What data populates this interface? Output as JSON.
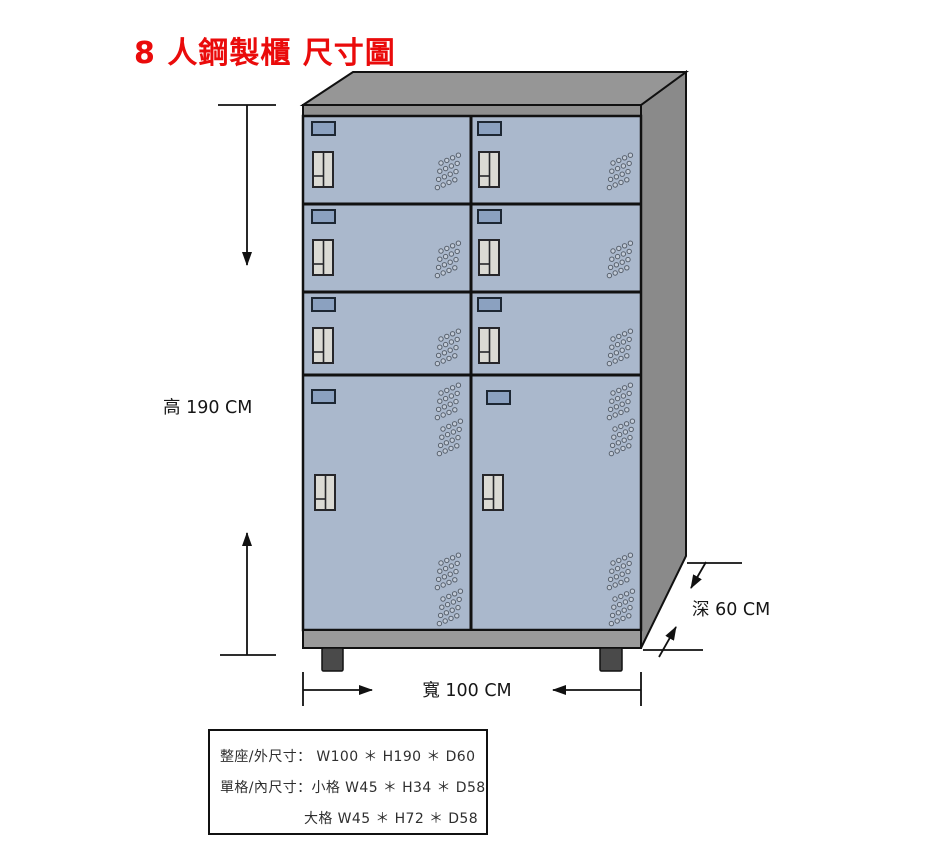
{
  "title": "8 人鋼製櫃 尺寸圖",
  "dimension_labels": {
    "height": "高 190 CM",
    "width": "寬 100 CM",
    "depth": "深 60 CM"
  },
  "dimensions_cm": {
    "height": 190,
    "width": 100,
    "depth": 60
  },
  "cabinet": {
    "door_count": 8,
    "small_doors": 6,
    "large_doors": 2
  },
  "spec_box": {
    "outer_line": "整座/外尺寸：  W100 ＊ H190 ＊ D60",
    "inner_small_line": "單格/內尺寸：小格 W45 ＊ H34 ＊ D58",
    "inner_large_line": "大格 W45 ＊ H72 ＊ D58"
  },
  "colors": {
    "title_red": "#ea0b0b",
    "door_face": "#aab8cc",
    "nameplate": "#8ba1c0",
    "handle": "#dbdad4",
    "cabinet_top": "#969696",
    "cabinet_side": "#8a8a8a",
    "base_strip": "#9a9a9a",
    "foot": "#4a4a4a",
    "outline": "#111111"
  }
}
